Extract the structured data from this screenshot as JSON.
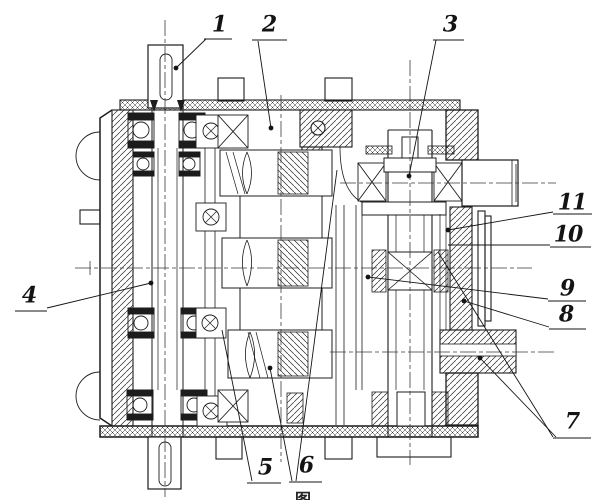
{
  "figure": {
    "description": "Sectional assembly drawing of a two-stage gear reducer (vertical shafts, ball bearings, helical gears) with numbered part callouts",
    "caption_partial": "图",
    "background_color": "#ffffff",
    "line_color": "#1c1c1c"
  },
  "callouts": [
    {
      "label": "1",
      "label_x": 219,
      "label_y": 26,
      "underline": [
        204,
        39,
        232,
        39
      ],
      "leaders": [
        [
          [
            206,
            39
          ],
          [
            176,
            68
          ]
        ]
      ],
      "dots": [
        [
          176,
          68
        ]
      ]
    },
    {
      "label": "2",
      "label_x": 269,
      "label_y": 26,
      "underline": [
        252,
        40,
        287,
        40
      ],
      "leaders": [
        [
          [
            258,
            41
          ],
          [
            271,
            128
          ]
        ]
      ],
      "dots": [
        [
          271,
          128
        ]
      ]
    },
    {
      "label": "3",
      "label_x": 450,
      "label_y": 26,
      "underline": [
        433,
        40,
        464,
        40
      ],
      "leaders": [
        [
          [
            436,
            40
          ],
          [
            409,
            176
          ]
        ]
      ],
      "dots": [
        [
          409,
          176
        ]
      ]
    },
    {
      "label": "4",
      "label_x": 29,
      "label_y": 297,
      "underline": [
        15,
        311,
        47,
        311
      ],
      "leaders": [
        [
          [
            47,
            308
          ],
          [
            151,
            283
          ]
        ]
      ],
      "dots": [
        [
          151,
          283
        ]
      ]
    },
    {
      "label": "5",
      "label_x": 265,
      "label_y": 469,
      "underline": [
        247,
        483,
        281,
        483
      ],
      "leaders": [
        [
          [
            252,
            481
          ],
          [
            222,
            330
          ]
        ]
      ],
      "dots": []
    },
    {
      "label": "6",
      "label_x": 306,
      "label_y": 467,
      "underline": [
        289,
        482,
        322,
        482
      ],
      "leaders": [
        [
          [
            292,
            481
          ],
          [
            270,
            368
          ]
        ],
        [
          [
            296,
            481
          ],
          [
            337,
            170
          ]
        ]
      ],
      "dots": [
        [
          270,
          368
        ]
      ]
    },
    {
      "label": "7",
      "label_x": 572,
      "label_y": 423,
      "underline": [
        553,
        438,
        591,
        438
      ],
      "leaders": [
        [
          [
            553,
            437
          ],
          [
            438,
            252
          ]
        ],
        [
          [
            556,
            437
          ],
          [
            480,
            358
          ]
        ]
      ],
      "dots": [
        [
          480,
          358
        ]
      ]
    },
    {
      "label": "8",
      "label_x": 566,
      "label_y": 316,
      "underline": [
        549,
        329,
        586,
        329
      ],
      "leaders": [
        [
          [
            549,
            327
          ],
          [
            464,
            301
          ]
        ]
      ],
      "dots": [
        [
          464,
          301
        ]
      ]
    },
    {
      "label": "9",
      "label_x": 567,
      "label_y": 290,
      "underline": [
        548,
        301,
        586,
        301
      ],
      "leaders": [
        [
          [
            548,
            299
          ],
          [
            368,
            277
          ]
        ]
      ],
      "dots": [
        [
          368,
          277
        ]
      ]
    },
    {
      "label": "10",
      "label_x": 568,
      "label_y": 236,
      "underline": [
        550,
        247,
        591,
        247
      ],
      "leaders": [
        [
          [
            550,
            245
          ],
          [
            448,
            245
          ]
        ]
      ],
      "dots": []
    },
    {
      "label": "11",
      "label_x": 572,
      "label_y": 204,
      "underline": [
        553,
        214,
        592,
        214
      ],
      "leaders": [
        [
          [
            553,
            212
          ],
          [
            448,
            230
          ]
        ]
      ],
      "dots": [
        [
          448,
          230
        ]
      ]
    }
  ]
}
